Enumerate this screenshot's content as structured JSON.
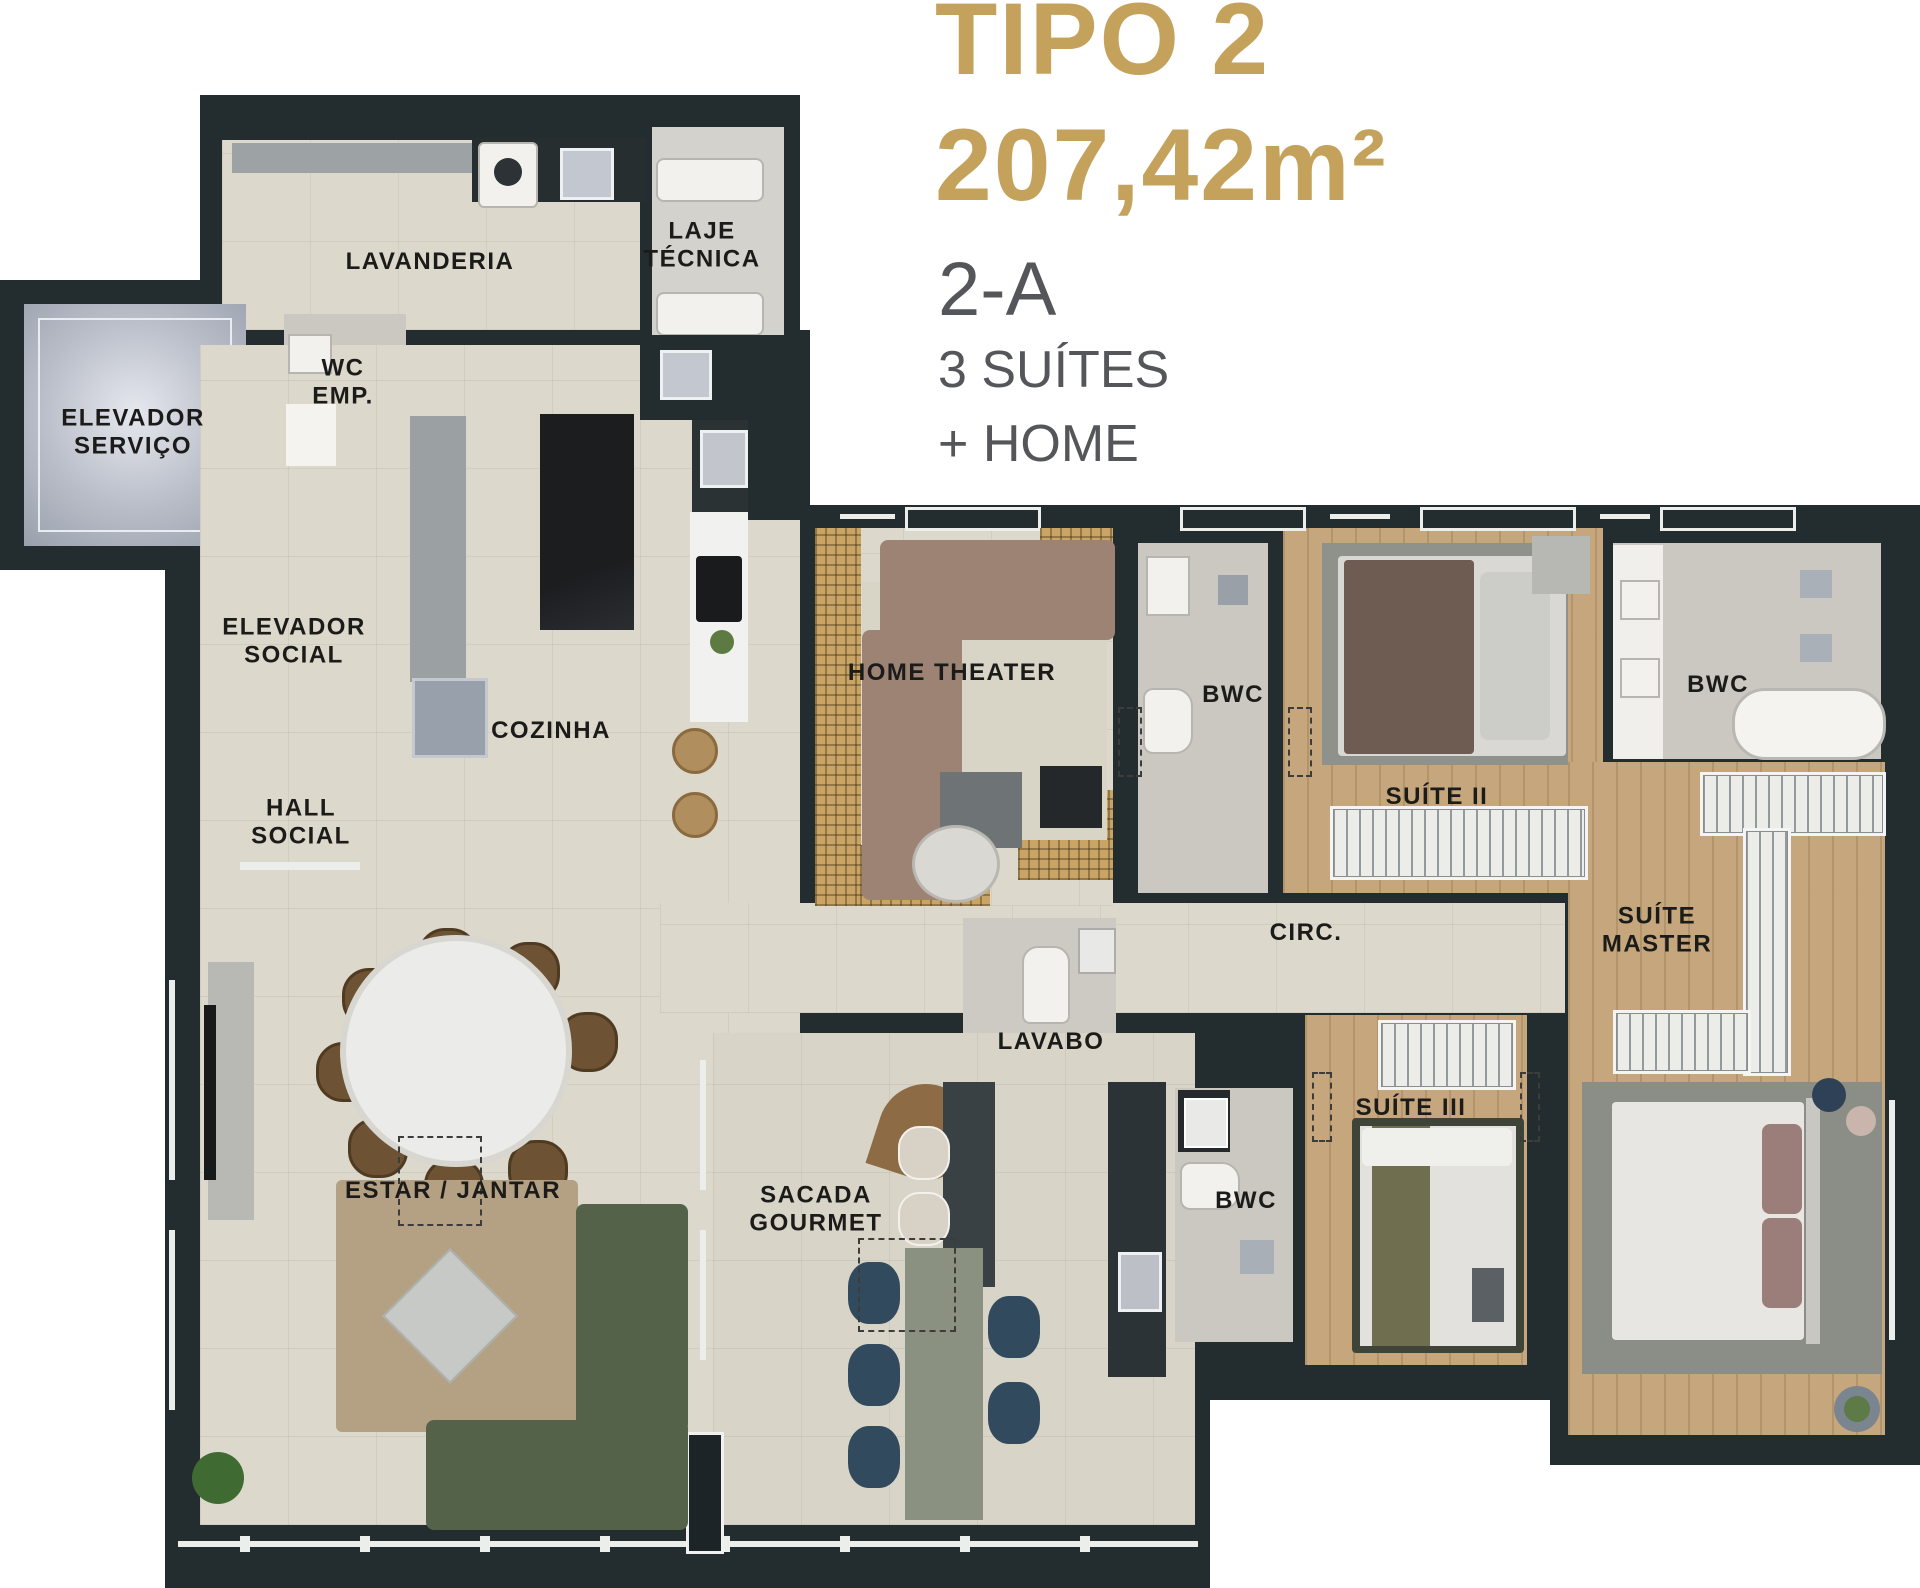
{
  "title": {
    "line1": "TIPO 2",
    "line2": "207,42m²",
    "unit": "2-A",
    "feature1": "3 SUÍTES",
    "feature2": "+ HOME"
  },
  "rooms": {
    "lavanderia": "LAVANDERIA",
    "laje_tecnica": "LAJE\nTÉCNICA",
    "wc_emp": "WC\nEMP.",
    "elevador_servico": "ELEVADOR\nSERVIÇO",
    "elevador_social": "ELEVADOR\nSOCIAL",
    "hall_social": "HALL\nSOCIAL",
    "cozinha": "COZINHA",
    "home_theater": "HOME THEATER",
    "bwc_suite_2": "BWC",
    "suite_2": "SUÍTE II",
    "bwc_master": "BWC",
    "suite_master": "SUÍTE\nMASTER",
    "circulacao": "CIRC.",
    "lavabo": "LAVABO",
    "suite_3": "SUÍTE III",
    "bwc_suite_3": "BWC",
    "sacada_gourmet": "SACADA\nGOURMET",
    "estar_jantar": "ESTAR / JANTAR"
  },
  "colors": {
    "accent_gold": "#c5a25c",
    "subtitle_gray": "#55565a",
    "wall_dark": "#232c2f",
    "floor_beige": "#dcd8cb",
    "floor_wood": "#c6a77d"
  }
}
